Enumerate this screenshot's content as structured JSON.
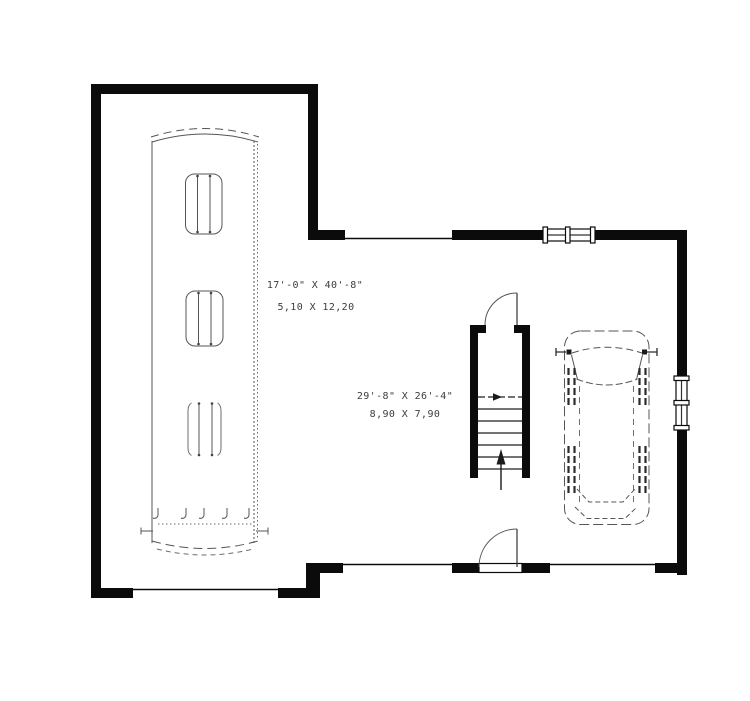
{
  "plan": {
    "colors": {
      "wall": "#0b0b0b",
      "sketch": "#555555",
      "text": "#3d3d3d",
      "background": "#ffffff"
    },
    "labels": {
      "rv_bay_imperial": "17'-0\" X 40'-8\"",
      "rv_bay_metric": "5,10 X 12,20",
      "garage_imperial": "29'-8\" X 26'-4\"",
      "garage_metric": "8,90 X 7,90"
    },
    "icons": {
      "stairs_direction": "up-arrow",
      "doors": "quarter-circle-swing",
      "windows": "triple-tick-window"
    }
  }
}
